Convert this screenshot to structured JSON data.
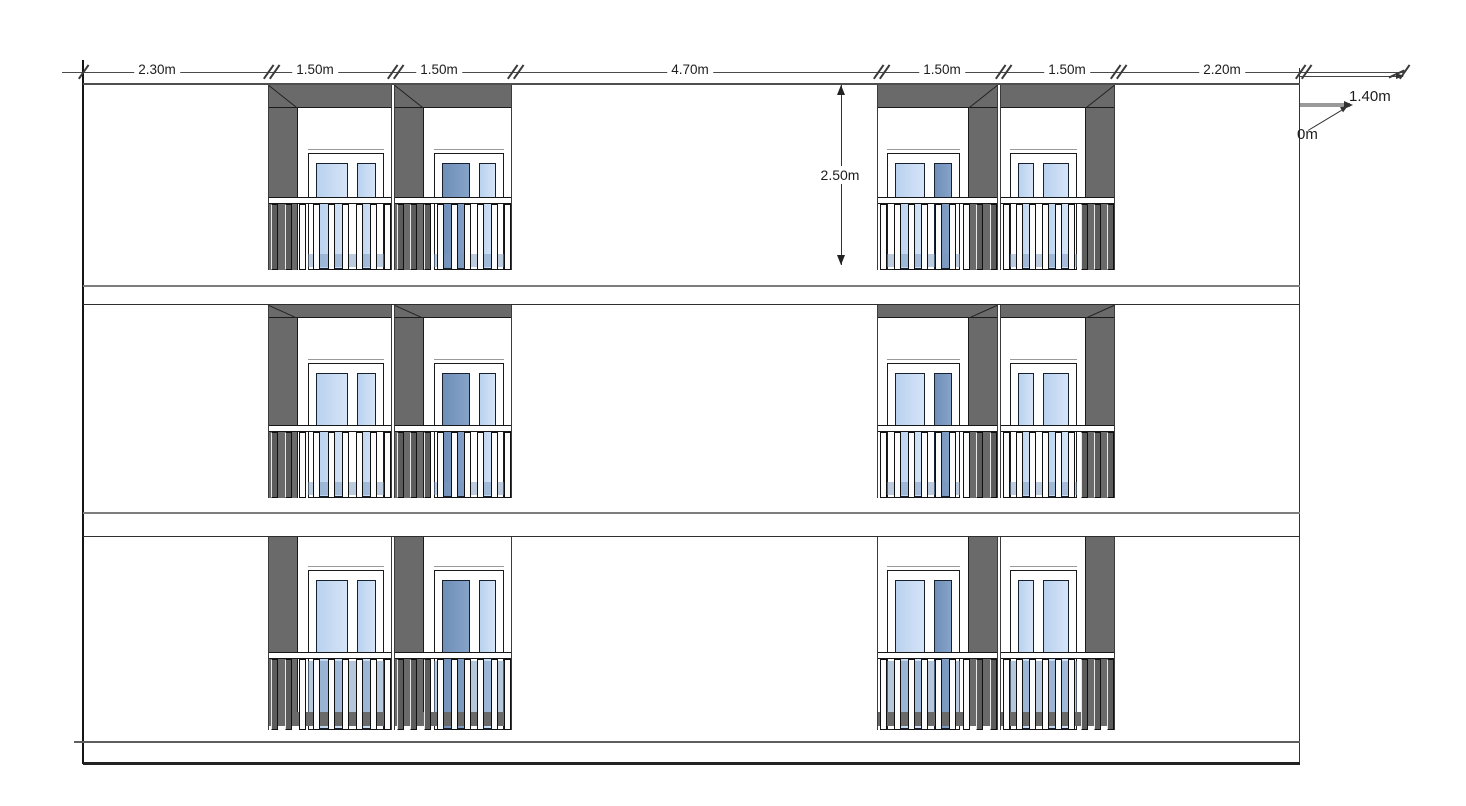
{
  "dimensions": {
    "top_chain": [
      {
        "label": "2.30m"
      },
      {
        "label": "1.50m"
      },
      {
        "label": "1.50m"
      },
      {
        "label": "4.70m"
      },
      {
        "label": "1.50m"
      },
      {
        "label": "1.50m"
      },
      {
        "label": "2.20m"
      }
    ],
    "story_height": {
      "label": "2.50m"
    },
    "right_side": {
      "top_label": "1.40m",
      "clipped_label": "0m"
    }
  },
  "facade": {
    "floor_count": 3,
    "window_units_per_floor": 4,
    "colors": {
      "wall": "#ffffff",
      "reveal_gray": "#6a6a6a",
      "baluster_gray": "#5c5c5c",
      "baluster_white": "#fcfcfc",
      "glass_light_a": "#b9d2ee",
      "glass_light_b": "#d5e4f8",
      "glass_dark_a": "#6f8fb8",
      "glass_dark_b": "#86a3c9",
      "glass_lower": "#8aa6c9",
      "foot_gray": "#6a6a6a",
      "outline": "#1a1a1a",
      "dim_text": "#1d1d1d"
    },
    "units": [
      {
        "name": "left-outer",
        "pillar_side": "left",
        "panes": [
          {
            "size": "wide",
            "tone": "light"
          },
          {
            "size": "narrow",
            "tone": "light"
          }
        ]
      },
      {
        "name": "left-inner",
        "pillar_side": "left",
        "panes": [
          {
            "size": "wide",
            "tone": "dark"
          },
          {
            "size": "narrow",
            "tone": "light"
          }
        ]
      },
      {
        "name": "right-inner",
        "pillar_side": "right",
        "panes": [
          {
            "size": "wide",
            "tone": "light"
          },
          {
            "size": "narrow",
            "tone": "dark"
          }
        ]
      },
      {
        "name": "right-outer",
        "pillar_side": "right",
        "panes": [
          {
            "size": "narrow",
            "tone": "light"
          },
          {
            "size": "wide",
            "tone": "light"
          }
        ]
      }
    ]
  }
}
